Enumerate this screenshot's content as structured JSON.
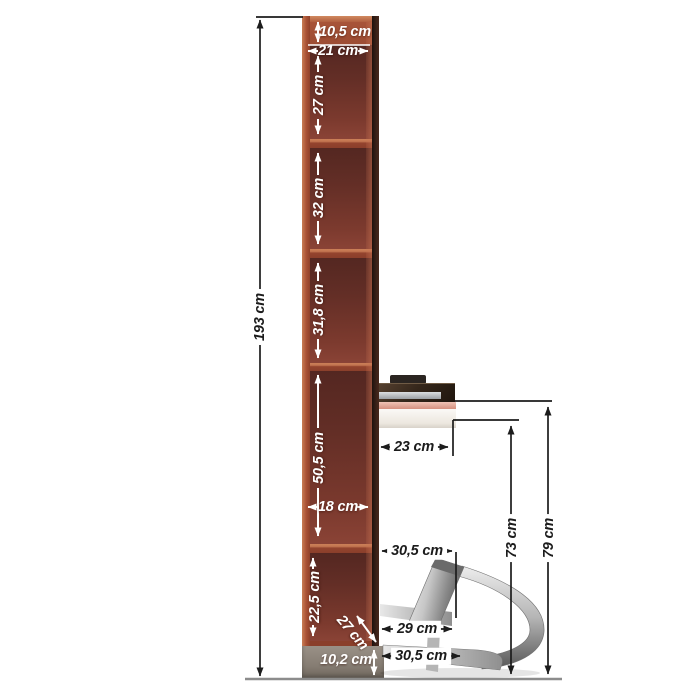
{
  "diagram": {
    "kind": "furniture-dimension-diagram",
    "subject": "tall narrow shelf with wall desk and folding chrome stool"
  },
  "dims": {
    "top_depth": "10,5 cm",
    "outer_width": "21 cm",
    "compartment_1_height": "27 cm",
    "compartment_2_height": "32 cm",
    "compartment_3_height": "31,8 cm",
    "total_height": "193 cm",
    "compartment_4_height": "50,5 cm",
    "inner_width": "18 cm",
    "desk_depth": "23 cm",
    "stool_top_width": "30,5 cm",
    "desk_clearance_height": "73 cm",
    "desk_surface_height": "79 cm",
    "compartment_5_height": "22,5 cm",
    "base_diagonal_depth": "27 cm",
    "stool_seat_width": "29 cm",
    "stool_base_width": "30,5 cm",
    "plinth_height": "10,2 cm"
  },
  "colors": {
    "background": "#ffffff",
    "wood-edge": "#b4593c",
    "wood-interior": "#6a3129",
    "wood-divider": "#98452f",
    "wood-dark-edge": "#2c1b15",
    "desk-top": "#2e2218",
    "desk-pink": "#e2a799",
    "drawer-white": "#f7f4f0",
    "plinth": "#8d857a",
    "dim-black": "#1c1c1c",
    "dim-white": "#ffffff",
    "floor-line": "#8c8c8c",
    "chrome-light": "#ededed",
    "chrome-dark": "#5e5e5e"
  }
}
